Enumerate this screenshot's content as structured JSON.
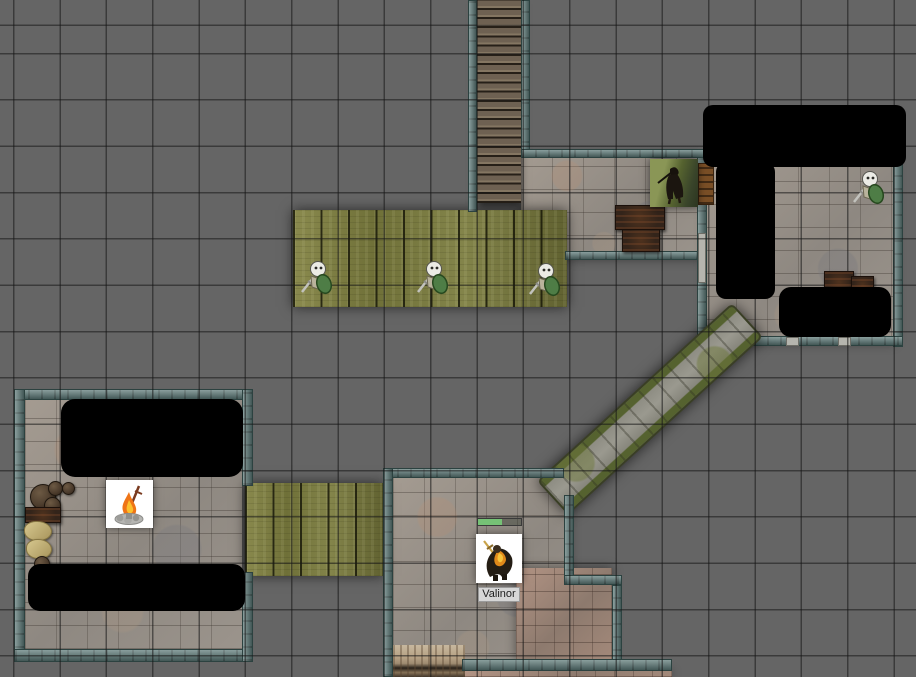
{
  "app": {
    "view": "virtual-tabletop-map"
  },
  "map": {
    "grid_size_px": 46,
    "background_color": "#656565",
    "grid_line_color": "#2f2f2f",
    "wall_color": "#5c7977",
    "fog_color": "#000000",
    "stone_floor_color": "#97908a",
    "wood_floor_color": "#7b7a42",
    "stairs_color": "#6e6152"
  },
  "player_token": {
    "label": "Valinor",
    "health_percent": 55,
    "health_bar_color": "#76c276"
  },
  "npc_tokens": {
    "skeleton_warrior_count": 4,
    "dark_cloaked_figure_count": 1
  },
  "object_tokens": {
    "campfire_count": 1,
    "crate_count": 4,
    "barrel_count": 5,
    "sack_count": 2,
    "shelf_count": 1
  }
}
